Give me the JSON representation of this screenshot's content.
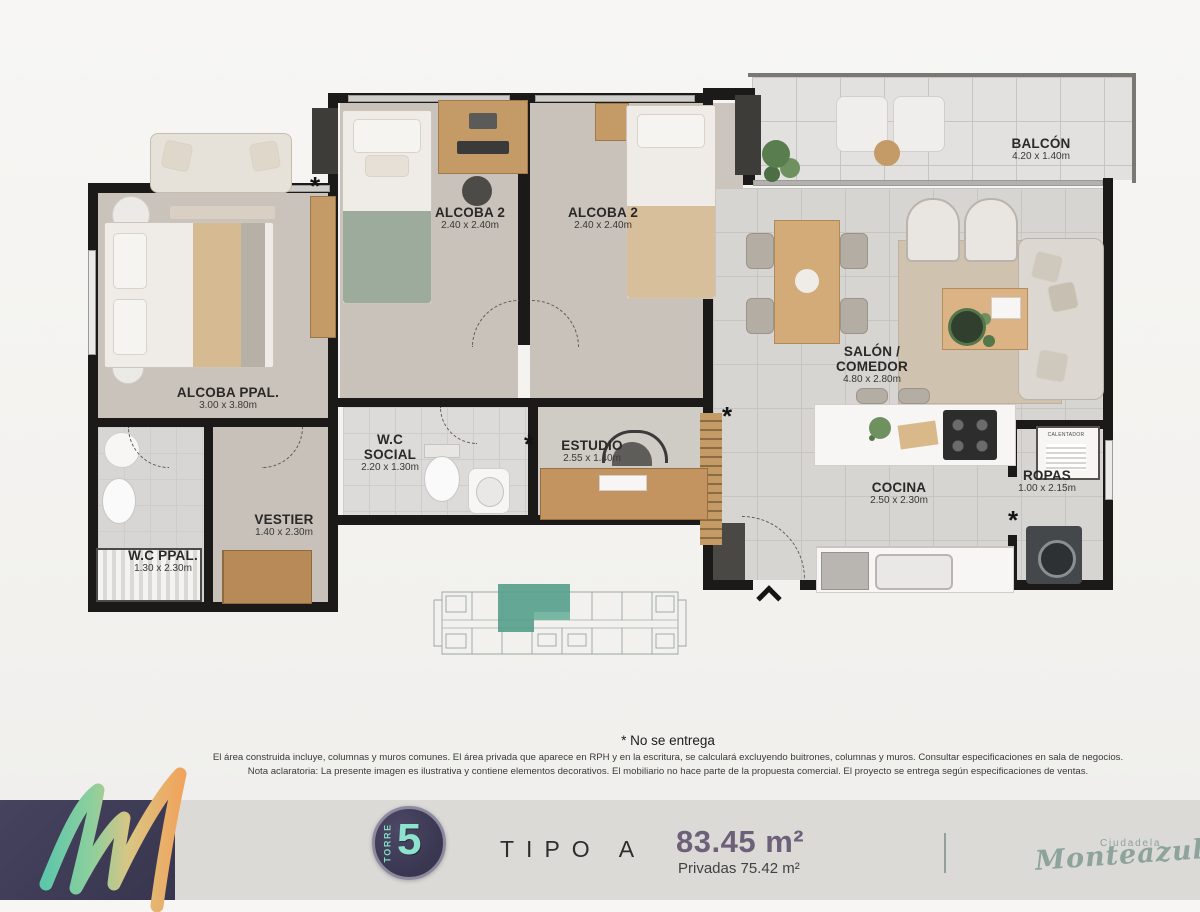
{
  "plan": {
    "rooms": {
      "alcoba_ppal": {
        "name": "ALCOBA PPAL.",
        "dims": "3.00 x 3.80m"
      },
      "alcoba2_a": {
        "name": "ALCOBA 2",
        "dims": "2.40 x 2.40m"
      },
      "alcoba2_b": {
        "name": "ALCOBA 2",
        "dims": "2.40 x 2.40m"
      },
      "balcon": {
        "name": "BALCÓN",
        "dims": "4.20 x 1.40m"
      },
      "salon": {
        "name": "SALÓN / COMEDOR",
        "dims": "4.80 x 2.80m"
      },
      "wc_social": {
        "name": "W.C SOCIAL",
        "dims": "2.20 x 1.30m"
      },
      "estudio": {
        "name": "ESTUDIO",
        "dims": "2.55 x 1.40m"
      },
      "vestier": {
        "name": "VESTIER",
        "dims": "1.40 x 2.30m"
      },
      "cocina": {
        "name": "COCINA",
        "dims": "2.50 x 2.30m"
      },
      "ropas": {
        "name": "ROPAS",
        "dims": "1.00 x 2.15m"
      },
      "wc_ppal": {
        "name": "W.C PPAL.",
        "dims": "1.30 x 2.30m"
      }
    },
    "marker": "*",
    "heater_label": "CALENTADOR"
  },
  "notes": {
    "no_entrega": "* No se entrega",
    "line1": "El área construida incluye, columnas y muros comunes. El área privada que aparece en RPH y en la escritura, se calculará excluyendo buitrones, columnas y muros. Consultar especificaciones en sala de negocios.",
    "line2": "Nota aclaratoria: La presente imagen es ilustrativa y contiene elementos decorativos. El mobiliario no hace parte de la propuesta comercial. El proyecto se entrega según especificaciones de ventas."
  },
  "footer": {
    "tower_word": "TORRE",
    "tower_number": "5",
    "type_label": "TIPO A",
    "area_total": "83.45 m²",
    "area_private": "Privadas 75.42 m²",
    "brand_top": "Ciudadela",
    "brand_name": "Monteazul"
  },
  "colors": {
    "accent_teal": "#57a18c",
    "footer_navy": "#3f3d56",
    "area_purple": "#6d6079",
    "brand_green": "#8da39c",
    "wall_black": "#1b1a18"
  }
}
